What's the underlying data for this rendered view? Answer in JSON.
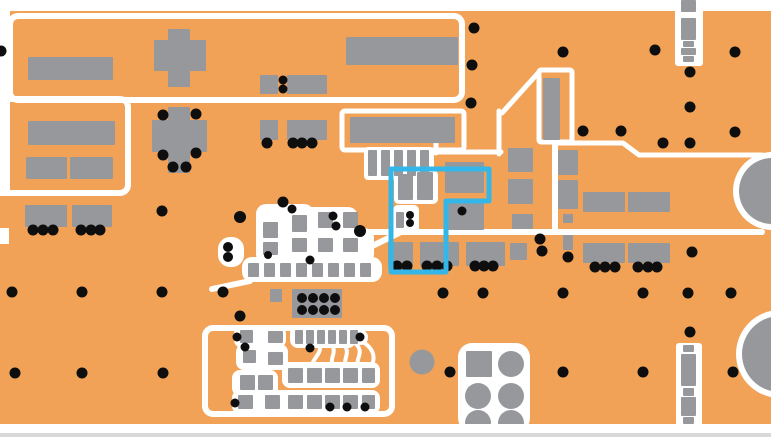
{
  "pcb": {
    "canvas": {
      "w": 771,
      "h": 437
    },
    "colors": {
      "copper": "#F1A257",
      "pad": "#96989B",
      "silk": "#FFFFFF",
      "drill": "#0E0E0E",
      "highlight": "#35B6E9",
      "edge_line": "#D9D9D9"
    },
    "via_default_r": 5.5,
    "margins_early": [
      [
        0,
        0,
        771,
        11
      ],
      [
        0,
        11,
        10,
        185
      ],
      [
        0,
        228,
        9,
        16
      ]
    ],
    "margins_late": [
      [
        0,
        424,
        771,
        13
      ]
    ],
    "edge_lines": [
      [
        0,
        433,
        771,
        4
      ]
    ],
    "outline_rects": [
      [
        10,
        16,
        452,
        84,
        8,
        6
      ],
      [
        -30,
        99,
        158,
        94,
        8,
        6
      ],
      [
        342,
        111,
        122,
        39,
        3,
        5
      ],
      [
        539,
        70,
        33,
        72,
        2,
        5
      ],
      [
        205,
        328,
        187,
        86,
        8,
        6
      ]
    ],
    "white_strokes": [
      {
        "d": "M555,143 L623,143 L639,155 L762,155",
        "w": 5
      },
      {
        "d": "M555,141 L555,232",
        "w": 6
      },
      {
        "d": "M350,232 L762,232",
        "w": 6
      },
      {
        "d": "M502,113 L539,72",
        "w": 5
      },
      {
        "d": "M436,128 L436,153",
        "w": 5
      },
      {
        "d": "M434,152 L501,152",
        "w": 5
      },
      {
        "d": "M499,111 L499,154",
        "w": 5
      },
      {
        "d": "M250,281 L212,289",
        "w": 6
      },
      {
        "d": "M366,249 L399,233",
        "w": 6
      },
      {
        "d": "M253,337 L270,337",
        "w": 4
      },
      {
        "d": "M320,344 C322,356 310,358 312,371",
        "w": 4
      },
      {
        "d": "M332,344 C338,356 326,358 336,371",
        "w": 4
      },
      {
        "d": "M344,344 C352,356 340,358 348,371",
        "w": 4
      },
      {
        "d": "M356,344 C366,354 352,360 360,371",
        "w": 4
      },
      {
        "d": "M360,340 C374,348 378,358 368,372",
        "w": 4
      }
    ],
    "white_fills": [
      [
        675,
        8,
        28,
        58,
        3
      ],
      [
        676,
        343,
        26,
        83,
        3
      ],
      [
        458,
        343,
        72,
        89,
        14
      ],
      [
        256,
        204,
        58,
        60,
        10
      ],
      [
        286,
        207,
        72,
        42,
        10
      ],
      [
        312,
        228,
        62,
        36,
        10
      ],
      [
        242,
        257,
        140,
        25,
        10
      ],
      [
        218,
        237,
        26,
        30,
        12
      ],
      [
        393,
        205,
        26,
        30,
        5
      ],
      [
        394,
        170,
        44,
        34,
        5
      ],
      [
        364,
        147,
        70,
        33,
        4
      ],
      [
        234,
        326,
        52,
        22,
        8
      ],
      [
        290,
        326,
        66,
        22,
        8
      ],
      [
        236,
        344,
        52,
        26,
        8
      ],
      [
        282,
        362,
        98,
        26,
        8
      ],
      [
        232,
        370,
        46,
        26,
        8
      ],
      [
        232,
        390,
        148,
        24,
        8
      ],
      [
        353,
        330,
        15,
        15,
        7
      ]
    ],
    "pads": [
      [
        28,
        57,
        85,
        23
      ],
      [
        154,
        40,
        52,
        31
      ],
      [
        168,
        29,
        22,
        58
      ],
      [
        346,
        37,
        112,
        28
      ],
      [
        260,
        75,
        18,
        19
      ],
      [
        287,
        75,
        40,
        19
      ],
      [
        260,
        120,
        18,
        20
      ],
      [
        287,
        120,
        40,
        20
      ],
      [
        28,
        121,
        87,
        24
      ],
      [
        26,
        157,
        41,
        22
      ],
      [
        70,
        157,
        43,
        22
      ],
      [
        152,
        120,
        55,
        32
      ],
      [
        168,
        107,
        22,
        66
      ],
      [
        25,
        205,
        42,
        22
      ],
      [
        72,
        205,
        40,
        22
      ],
      [
        350,
        117,
        105,
        26
      ],
      [
        368,
        150,
        9,
        26
      ],
      [
        381,
        150,
        9,
        26
      ],
      [
        394,
        150,
        9,
        26
      ],
      [
        407,
        150,
        9,
        26
      ],
      [
        420,
        150,
        9,
        26
      ],
      [
        543,
        78,
        17,
        62
      ],
      [
        445,
        162,
        39,
        31
      ],
      [
        417,
        172,
        16,
        28
      ],
      [
        398,
        174,
        15,
        26
      ],
      [
        447,
        203,
        37,
        27
      ],
      [
        396,
        212,
        8,
        16
      ],
      [
        508,
        148,
        25,
        24
      ],
      [
        508,
        179,
        25,
        25
      ],
      [
        512,
        214,
        21,
        15
      ],
      [
        510,
        243,
        17,
        17
      ],
      [
        558,
        150,
        20,
        25
      ],
      [
        558,
        180,
        20,
        29
      ],
      [
        563,
        214,
        10,
        9
      ],
      [
        563,
        235,
        10,
        15
      ],
      [
        583,
        192,
        42,
        20
      ],
      [
        628,
        192,
        42,
        20
      ],
      [
        583,
        243,
        42,
        20
      ],
      [
        628,
        243,
        42,
        20
      ],
      [
        388,
        242,
        25,
        24
      ],
      [
        420,
        242,
        39,
        24
      ],
      [
        466,
        242,
        39,
        24
      ],
      [
        263,
        222,
        15,
        16
      ],
      [
        263,
        242,
        15,
        13
      ],
      [
        292,
        215,
        15,
        17
      ],
      [
        292,
        238,
        15,
        14
      ],
      [
        318,
        212,
        15,
        16
      ],
      [
        318,
        238,
        15,
        14
      ],
      [
        343,
        212,
        15,
        16
      ],
      [
        343,
        238,
        15,
        14
      ],
      [
        248,
        263,
        11,
        14
      ],
      [
        264,
        263,
        11,
        14
      ],
      [
        280,
        263,
        11,
        14
      ],
      [
        296,
        263,
        11,
        14
      ],
      [
        312,
        263,
        11,
        14
      ],
      [
        328,
        263,
        11,
        14
      ],
      [
        344,
        263,
        11,
        14
      ],
      [
        360,
        263,
        11,
        14
      ],
      [
        292,
        289,
        50,
        29
      ],
      [
        270,
        289,
        12,
        13
      ],
      [
        240,
        330,
        13,
        13
      ],
      [
        268,
        331,
        15,
        12
      ],
      [
        295,
        330,
        8,
        14
      ],
      [
        306,
        330,
        8,
        14
      ],
      [
        317,
        330,
        8,
        14
      ],
      [
        328,
        330,
        8,
        14
      ],
      [
        339,
        330,
        8,
        14
      ],
      [
        350,
        330,
        8,
        14
      ],
      [
        243,
        350,
        13,
        13
      ],
      [
        268,
        352,
        15,
        13
      ],
      [
        288,
        368,
        15,
        15
      ],
      [
        307,
        368,
        15,
        15
      ],
      [
        325,
        368,
        15,
        15
      ],
      [
        343,
        368,
        15,
        15
      ],
      [
        362,
        368,
        13,
        15
      ],
      [
        240,
        375,
        15,
        15
      ],
      [
        258,
        375,
        15,
        15
      ],
      [
        238,
        395,
        15,
        14
      ],
      [
        265,
        395,
        15,
        14
      ],
      [
        288,
        395,
        15,
        14
      ],
      [
        307,
        395,
        15,
        14
      ],
      [
        325,
        395,
        15,
        14
      ],
      [
        343,
        395,
        15,
        14
      ],
      [
        362,
        395,
        13,
        14
      ],
      [
        466,
        351,
        26,
        26
      ],
      [
        681,
        0,
        15,
        12
      ],
      [
        681,
        18,
        15,
        22
      ],
      [
        683,
        41,
        11,
        6
      ],
      [
        681,
        48,
        15,
        7
      ],
      [
        683,
        56,
        11,
        6
      ],
      [
        683,
        345,
        11,
        7
      ],
      [
        681,
        354,
        15,
        32
      ],
      [
        683,
        388,
        11,
        8
      ],
      [
        681,
        397,
        15,
        19
      ],
      [
        683,
        417,
        11,
        7
      ]
    ],
    "pad_circles": [
      [
        511,
        364,
        13
      ],
      [
        478,
        396,
        13
      ],
      [
        511,
        396,
        13
      ],
      [
        478,
        423,
        13
      ],
      [
        511,
        423,
        13
      ],
      [
        422,
        362,
        12.5
      ]
    ],
    "big_circles": [
      {
        "cx": 772,
        "cy": 191,
        "r": 33,
        "ring": 6
      },
      {
        "cx": 780,
        "cy": 354,
        "r": 38,
        "ring": 6
      }
    ],
    "vias": [
      [
        1,
        51
      ],
      [
        474,
        28
      ],
      [
        472,
        65
      ],
      [
        471,
        103
      ],
      [
        563,
        52
      ],
      [
        655,
        50
      ],
      [
        735,
        52
      ],
      [
        690,
        72
      ],
      [
        690,
        107
      ],
      [
        283,
        80,
        4.5
      ],
      [
        283,
        89,
        4.5
      ],
      [
        267,
        143
      ],
      [
        293,
        143
      ],
      [
        302,
        143
      ],
      [
        312,
        143
      ],
      [
        163,
        115
      ],
      [
        196,
        114
      ],
      [
        163,
        155
      ],
      [
        196,
        153
      ],
      [
        173,
        167
      ],
      [
        186,
        167
      ],
      [
        583,
        131
      ],
      [
        621,
        131
      ],
      [
        663,
        143
      ],
      [
        690,
        143
      ],
      [
        735,
        132
      ],
      [
        33,
        230
      ],
      [
        43,
        230
      ],
      [
        53,
        230
      ],
      [
        81,
        230
      ],
      [
        91,
        230
      ],
      [
        100,
        230
      ],
      [
        240,
        217,
        6
      ],
      [
        283,
        202
      ],
      [
        292,
        209,
        4.5
      ],
      [
        333,
        216,
        4.5
      ],
      [
        336,
        226,
        4.5
      ],
      [
        360,
        231,
        6
      ],
      [
        268,
        255,
        4
      ],
      [
        310,
        260,
        4.5
      ],
      [
        228,
        247,
        5
      ],
      [
        228,
        257,
        5
      ],
      [
        462,
        211,
        4.5
      ],
      [
        410,
        215,
        4
      ],
      [
        410,
        223,
        4
      ],
      [
        397,
        266
      ],
      [
        407,
        266
      ],
      [
        427,
        266
      ],
      [
        437,
        266
      ],
      [
        447,
        266
      ],
      [
        475,
        266
      ],
      [
        484,
        266
      ],
      [
        493,
        266
      ],
      [
        595,
        267
      ],
      [
        605,
        267
      ],
      [
        615,
        267
      ],
      [
        638,
        267
      ],
      [
        648,
        267
      ],
      [
        657,
        267
      ],
      [
        568,
        257
      ],
      [
        540,
        239
      ],
      [
        542,
        251
      ],
      [
        302,
        298,
        5
      ],
      [
        313,
        298,
        5
      ],
      [
        324,
        298,
        5
      ],
      [
        335,
        298,
        5
      ],
      [
        302,
        310,
        5
      ],
      [
        313,
        310,
        5
      ],
      [
        324,
        310,
        5
      ],
      [
        335,
        310,
        5
      ],
      [
        240,
        316
      ],
      [
        12,
        292
      ],
      [
        82,
        292
      ],
      [
        162,
        292
      ],
      [
        223,
        292
      ],
      [
        443,
        293
      ],
      [
        483,
        293
      ],
      [
        563,
        293
      ],
      [
        643,
        293
      ],
      [
        688,
        293
      ],
      [
        731,
        293
      ],
      [
        15,
        373
      ],
      [
        82,
        373
      ],
      [
        163,
        373
      ],
      [
        450,
        372
      ],
      [
        563,
        372
      ],
      [
        643,
        372
      ],
      [
        733,
        372
      ],
      [
        690,
        332
      ],
      [
        692,
        252
      ],
      [
        162,
        211
      ],
      [
        237,
        337,
        4.5
      ],
      [
        245,
        347,
        4.5
      ],
      [
        310,
        348,
        4.5
      ],
      [
        360,
        337,
        4.5
      ],
      [
        330,
        407,
        4.5
      ],
      [
        347,
        407,
        4.5
      ],
      [
        365,
        407,
        4.5
      ],
      [
        235,
        403,
        4.5
      ]
    ],
    "highlight_net": {
      "points": [
        [
          391,
          169
        ],
        [
          489,
          169
        ],
        [
          489,
          201
        ],
        [
          446,
          201
        ],
        [
          446,
          272
        ],
        [
          391,
          272
        ]
      ],
      "closed": true,
      "width": 5
    }
  }
}
